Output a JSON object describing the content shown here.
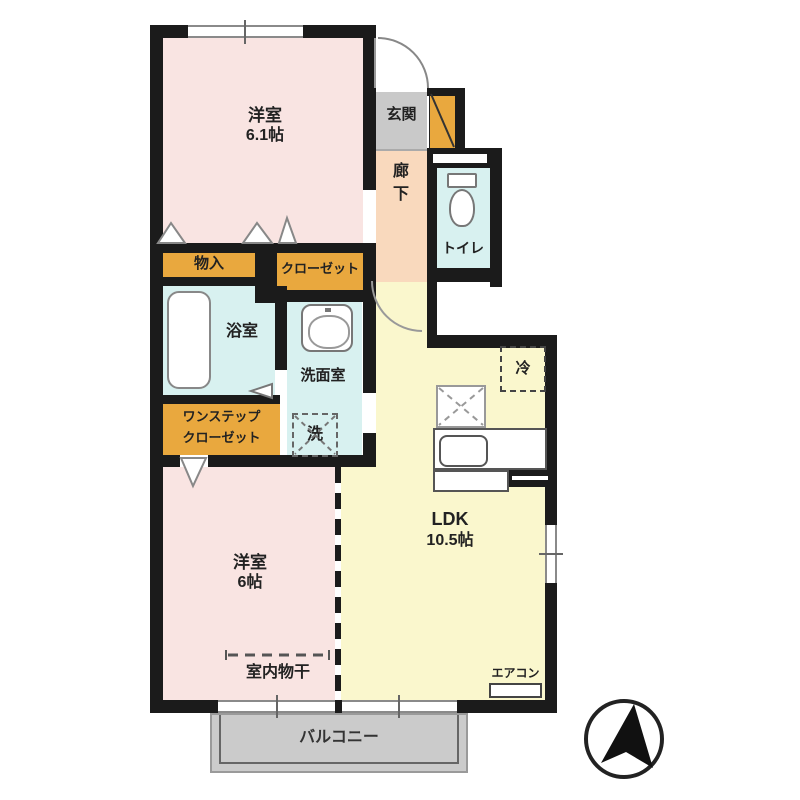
{
  "plan": {
    "type": "apartment-floor-plan",
    "compass_icon": "north-arrow"
  },
  "rooms": {
    "bedroom1": {
      "name": "洋室",
      "size": "6.1帖"
    },
    "bedroom2": {
      "name": "洋室",
      "size": "6帖"
    },
    "ldk": {
      "name": "LDK",
      "size": "10.5帖"
    },
    "entrance": {
      "label": "玄関"
    },
    "hallway": {
      "label": "廊下"
    },
    "toilet": {
      "label": "トイレ"
    },
    "bath": {
      "label": "浴室"
    },
    "washroom": {
      "label": "洗面室"
    },
    "storage": {
      "label": "物入"
    },
    "closet": {
      "label": "クローゼット"
    },
    "onestep_closet": {
      "line1": "ワンステップ",
      "line2": "クローゼット"
    },
    "balcony": {
      "label": "バルコニー"
    }
  },
  "fixtures": {
    "washer_label": "洗",
    "fridge_label": "冷",
    "aircon_label": "エアコン",
    "indoor_drying_label": "室内物干"
  },
  "colors": {
    "bedroom": "#f9e4e2",
    "ldk": "#faf7cd",
    "closet": "#e9a83e",
    "wet_area": "#d8f1f0",
    "entrance": "#c9c9c9",
    "hallway": "#f9d9bd",
    "balcony": "#cbcbcb",
    "wall": "#1b1b1b"
  }
}
